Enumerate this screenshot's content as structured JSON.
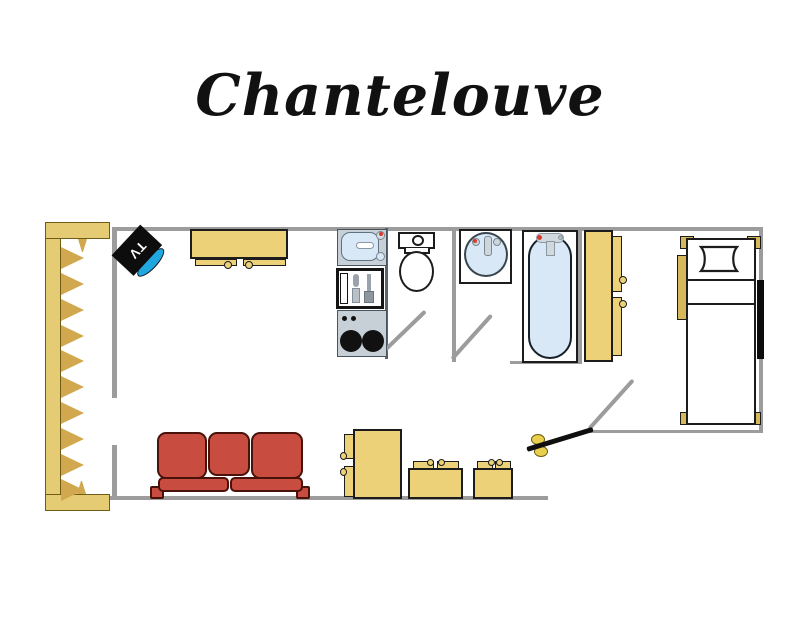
{
  "title": "Chantelouve",
  "floorplan": {
    "tv_label": "TV",
    "colors": {
      "wall": "#9c9c9c",
      "outline": "#1c1c1c",
      "yellow": "#ecd179",
      "yellow-dark": "#d6b85c",
      "balcony": "#e5cb73",
      "hatch": "#d2a84e",
      "sofa": "#c94c41",
      "sofa-line": "#49120a",
      "appliance": "#c7d0d7",
      "appliance-line": "#4a545c",
      "water": "#d8e8f6",
      "water-line": "#5f7280",
      "screen": "#21a7e0",
      "accent": "#d93a2b",
      "door": "#0f0f0f",
      "handle": "#e8cf4e"
    }
  }
}
